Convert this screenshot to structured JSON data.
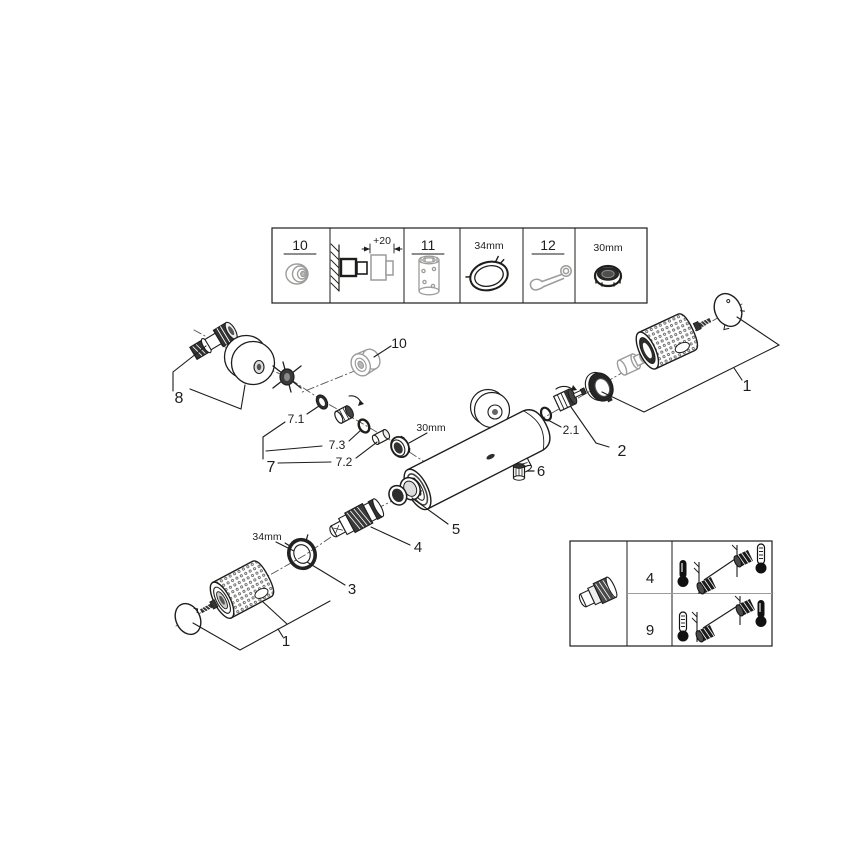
{
  "colors": {
    "line": "#1d1d1b",
    "grey": "#9c9c9b",
    "dark_fill": "#2e2e2e",
    "background": "#ffffff"
  },
  "top_parts_box": {
    "part10_label": "10",
    "extension_dimension": "+20",
    "part11_label": "11",
    "ring_size": "34mm",
    "part12_label": "12",
    "nut_size": "30mm",
    "icons": [
      "grommet-cap-icon",
      "wall-extension-diagram-icon",
      "extension-sleeve-icon",
      "friction-ring-icon",
      "open-end-wrench-icon",
      "cap-nut-icon"
    ]
  },
  "exploded_diagram": {
    "s_union_group_label": "8",
    "cover_cap_label": "10",
    "union_group_label": "7",
    "union_seal_label": "7.1",
    "union_sleeve_label": "7.2",
    "union_oring_label": "7.3",
    "union_nut_size": "30mm",
    "check_valve_oring_label": "2.1",
    "check_valve_group_label": "2",
    "handle_group_right_label": "1",
    "plug_screw_label": "6",
    "stop_ring_label": "5",
    "thermostat_cartridge_label": "4",
    "ring_nut_label": "3",
    "ring_nut_size": "34mm",
    "handle_group_bottom_label": "1"
  },
  "calibration_box": {
    "cartridge_icon": "thermostat-cartridge-icon",
    "rows": [
      {
        "part": "4",
        "from_thermometer": "hot-filled",
        "to_thermometer": "scale"
      },
      {
        "part": "9",
        "from_thermometer": "scale",
        "to_thermometer": "hot-filled"
      }
    ]
  }
}
